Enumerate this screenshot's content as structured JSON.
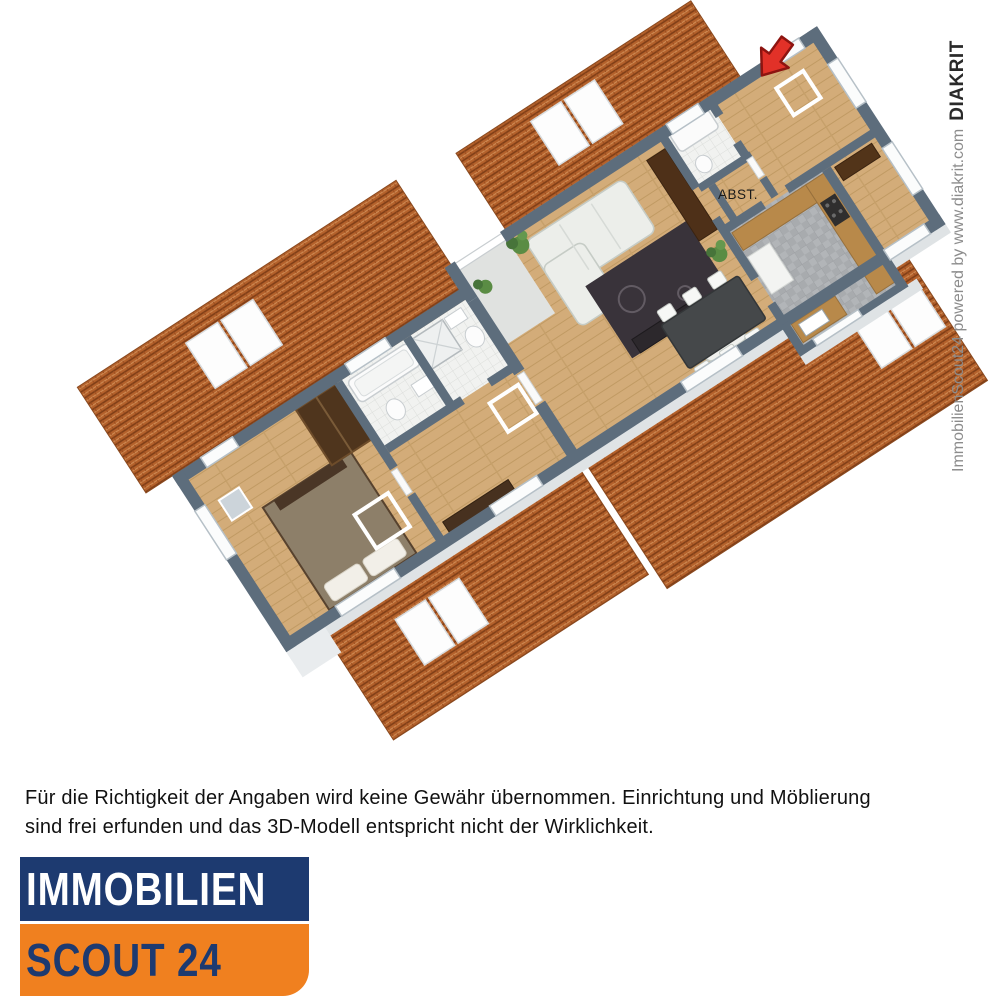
{
  "floorplan": {
    "room_label": "ABST.",
    "colors": {
      "roof_tile": "#b4612b",
      "roof_tile_dark": "#7e3d16",
      "roof_tile_light": "#cf8b54",
      "wall_top": "#5d6d7c",
      "wall_face": "#e6eaec",
      "wood_floor": "#d3ac79",
      "bath_tile": "#f1f2f0",
      "kitchen_tile": "#b2b5b8",
      "arrow_red": "#e23128"
    }
  },
  "watermark": {
    "powered": "ImmobilienScout24 powered by www.diakrit.com",
    "brand": "DIAKRIT"
  },
  "disclaimer": {
    "line1": "Für die Richtigkeit der Angaben wird keine Gewähr übernommen. Einrichtung und Möblierung",
    "line2": "sind frei erfunden und das 3D-Modell entspricht nicht der Wirklichkeit."
  },
  "logo": {
    "line1": "IMMOBILIEN",
    "line2": "SCOUT 24",
    "navy": "#1d3a70",
    "orange": "#f0801f",
    "text_light": "#ffffff"
  }
}
